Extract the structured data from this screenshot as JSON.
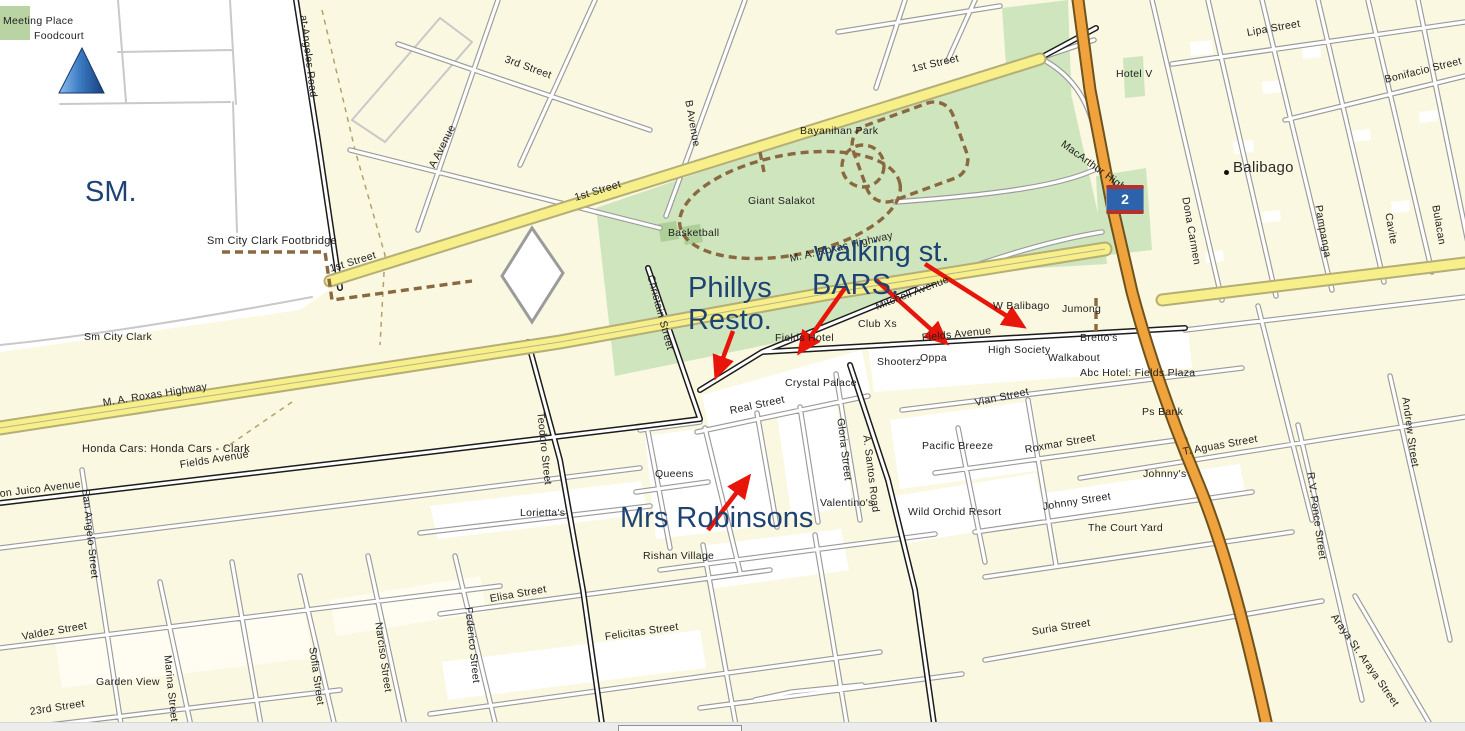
{
  "map": {
    "route_shield": {
      "number": "2"
    },
    "icons": [
      {
        "name": "blue-triangle-marker",
        "meaning": "map location cone marker"
      },
      {
        "name": "route-2-shield",
        "meaning": "highway route number 2"
      },
      {
        "name": "balibago-place-dot",
        "meaning": "place point marker"
      }
    ],
    "colors": {
      "annotation_blue": "#1e4373",
      "arrow_red": "#e8150a",
      "park_green": "#cfe5bd",
      "road_yellow": "#f7ef89",
      "highway_orange": "#f0a33c",
      "map_background": "#faf8e0"
    },
    "annotations": [
      {
        "text": "SM.",
        "x": 85,
        "y": 178,
        "rot": 0
      },
      {
        "text": "walking st.",
        "x": 814,
        "y": 238,
        "rot": 0
      },
      {
        "text": "BARS.",
        "x": 812,
        "y": 271,
        "rot": 0
      },
      {
        "text": "Phillys",
        "x": 688,
        "y": 274,
        "rot": 0
      },
      {
        "text": "Resto.",
        "x": 688,
        "y": 306,
        "rot": 0
      },
      {
        "text": "Mrs Robinsons",
        "x": 620,
        "y": 504,
        "rot": 0
      }
    ],
    "arrows": [
      {
        "x1": 845,
        "y1": 288,
        "x2": 801,
        "y2": 350
      },
      {
        "x1": 876,
        "y1": 280,
        "x2": 944,
        "y2": 341
      },
      {
        "x1": 925,
        "y1": 264,
        "x2": 1021,
        "y2": 325
      },
      {
        "x1": 733,
        "y1": 331,
        "x2": 717,
        "y2": 374
      },
      {
        "x1": 708,
        "y1": 530,
        "x2": 747,
        "y2": 479
      }
    ],
    "labels": [
      {
        "text": "Meeting Place",
        "x": 3,
        "y": 16,
        "rot": 0
      },
      {
        "text": "Foodcourt",
        "x": 34,
        "y": 31,
        "rot": 0
      },
      {
        "text": "Sm City Clark Footbridge",
        "x": 207,
        "y": 236,
        "rot": 0,
        "cls": "md"
      },
      {
        "text": "Sm City Clark",
        "x": 84,
        "y": 332,
        "rot": 0
      },
      {
        "text": "1st Street",
        "x": 330,
        "y": 264,
        "rot": -17
      },
      {
        "text": "at-Angeles Road",
        "x": 303,
        "y": 10,
        "rot": 83
      },
      {
        "text": "3rd Street",
        "x": 505,
        "y": 54,
        "rot": 20
      },
      {
        "text": "A Avenue",
        "x": 432,
        "y": 162,
        "rot": -63
      },
      {
        "text": "B Avenue",
        "x": 688,
        "y": 95,
        "rot": 80
      },
      {
        "text": "1st Street",
        "x": 575,
        "y": 193,
        "rot": -17
      },
      {
        "text": "1st Street",
        "x": 912,
        "y": 64,
        "rot": -13
      },
      {
        "text": "Bayanihan Park",
        "x": 800,
        "y": 126,
        "rot": 0
      },
      {
        "text": "Giant Salakot",
        "x": 748,
        "y": 196,
        "rot": 0
      },
      {
        "text": "Basketball",
        "x": 668,
        "y": 228,
        "rot": 0
      },
      {
        "text": "M. A. Roxas Highway",
        "x": 790,
        "y": 254,
        "rot": -13
      },
      {
        "text": "Hotel V",
        "x": 1116,
        "y": 69,
        "rot": 0
      },
      {
        "text": "Balibago",
        "x": 1233,
        "y": 160,
        "rot": 0,
        "cls": "lg"
      },
      {
        "text": "Lipa Street",
        "x": 1247,
        "y": 28,
        "rot": -10
      },
      {
        "text": "Bonifacio Street",
        "x": 1385,
        "y": 75,
        "rot": -14
      },
      {
        "text": "MacArthur Highway",
        "x": 1062,
        "y": 138,
        "rot": 36
      },
      {
        "text": "Dona Carmen",
        "x": 1185,
        "y": 192,
        "rot": 80
      },
      {
        "text": "Pampanga",
        "x": 1318,
        "y": 200,
        "rot": 80
      },
      {
        "text": "Cavite",
        "x": 1388,
        "y": 208,
        "rot": 80
      },
      {
        "text": "Bulacan",
        "x": 1435,
        "y": 200,
        "rot": 80
      },
      {
        "text": "Mitchell Avenue",
        "x": 876,
        "y": 302,
        "rot": -21
      },
      {
        "text": "Club Xs",
        "x": 858,
        "y": 319,
        "rot": 0
      },
      {
        "text": "Fields Hotel",
        "x": 775,
        "y": 333,
        "rot": 0
      },
      {
        "text": "Fields Avenue",
        "x": 922,
        "y": 333,
        "rot": -6
      },
      {
        "text": "W Balibago",
        "x": 993,
        "y": 301,
        "rot": 0
      },
      {
        "text": "Jumong",
        "x": 1062,
        "y": 304,
        "rot": 0
      },
      {
        "text": "Bretto's",
        "x": 1080,
        "y": 333,
        "rot": 0
      },
      {
        "text": "High Society",
        "x": 988,
        "y": 345,
        "rot": 0
      },
      {
        "text": "Walkabout",
        "x": 1048,
        "y": 353,
        "rot": 0
      },
      {
        "text": "Abc Hotel: Fields Plaza",
        "x": 1080,
        "y": 368,
        "rot": 0
      },
      {
        "text": "Shooterz",
        "x": 877,
        "y": 357,
        "rot": 0
      },
      {
        "text": "Oppa",
        "x": 920,
        "y": 353,
        "rot": 0
      },
      {
        "text": "Crystal Palace",
        "x": 785,
        "y": 378,
        "rot": 0
      },
      {
        "text": "Vian Street",
        "x": 975,
        "y": 398,
        "rot": -12
      },
      {
        "text": "Ps Bank",
        "x": 1142,
        "y": 407,
        "rot": 0
      },
      {
        "text": "Real Street",
        "x": 730,
        "y": 406,
        "rot": -12
      },
      {
        "text": "Gloria Street",
        "x": 840,
        "y": 413,
        "rot": 83
      },
      {
        "text": "A. Santos Road",
        "x": 866,
        "y": 430,
        "rot": 83
      },
      {
        "text": "Pacific Breeze",
        "x": 922,
        "y": 441,
        "rot": 0
      },
      {
        "text": "Queens",
        "x": 655,
        "y": 469,
        "rot": 0
      },
      {
        "text": "Valentino's",
        "x": 820,
        "y": 498,
        "rot": 0
      },
      {
        "text": "Wild Orchid Resort",
        "x": 908,
        "y": 507,
        "rot": 0
      },
      {
        "text": "Roxmar Street",
        "x": 1025,
        "y": 445,
        "rot": -10
      },
      {
        "text": "Johnny's",
        "x": 1143,
        "y": 469,
        "rot": 0
      },
      {
        "text": "T. Aguas Street",
        "x": 1183,
        "y": 447,
        "rot": -10
      },
      {
        "text": "Johnny Street",
        "x": 1043,
        "y": 502,
        "rot": -9
      },
      {
        "text": "The Court Yard",
        "x": 1088,
        "y": 523,
        "rot": 0
      },
      {
        "text": "Suria Street",
        "x": 1032,
        "y": 627,
        "rot": -9
      },
      {
        "text": "R.V. Ponce Street",
        "x": 1310,
        "y": 467,
        "rot": 82
      },
      {
        "text": "Andrew Street",
        "x": 1405,
        "y": 392,
        "rot": 82
      },
      {
        "text": "Araya St. Araya Street",
        "x": 1333,
        "y": 610,
        "rot": 55
      },
      {
        "text": "Honda Cars: Honda Cars - Clark",
        "x": 82,
        "y": 444,
        "rot": 0,
        "cls": "md"
      },
      {
        "text": "M. A. Roxas Highway",
        "x": 103,
        "y": 398,
        "rot": -9
      },
      {
        "text": "Fields Avenue",
        "x": 180,
        "y": 460,
        "rot": -9
      },
      {
        "text": "Don Juico Avenue",
        "x": -8,
        "y": 490,
        "rot": -7
      },
      {
        "text": "San Angelo Street",
        "x": 85,
        "y": 484,
        "rot": 84
      },
      {
        "text": "Valdez Street",
        "x": 22,
        "y": 632,
        "rot": -10
      },
      {
        "text": "Garden View",
        "x": 96,
        "y": 677,
        "rot": 0
      },
      {
        "text": "23rd Street",
        "x": 30,
        "y": 707,
        "rot": -9
      },
      {
        "text": "Marina Street",
        "x": 167,
        "y": 650,
        "rot": 84
      },
      {
        "text": "Sofia Street",
        "x": 312,
        "y": 642,
        "rot": 82
      },
      {
        "text": "Narciso Street",
        "x": 378,
        "y": 617,
        "rot": 82
      },
      {
        "text": "Federico Street",
        "x": 468,
        "y": 602,
        "rot": 84
      },
      {
        "text": "Elisa Street",
        "x": 490,
        "y": 594,
        "rot": -10
      },
      {
        "text": "Felicitas Street",
        "x": 605,
        "y": 632,
        "rot": -8
      },
      {
        "text": "Lorietta's",
        "x": 520,
        "y": 508,
        "rot": 0
      },
      {
        "text": "Rishan Village",
        "x": 643,
        "y": 551,
        "rot": 0
      },
      {
        "text": "Teodoro Street",
        "x": 540,
        "y": 407,
        "rot": 84
      },
      {
        "text": "Christain Street",
        "x": 650,
        "y": 270,
        "rot": 75
      }
    ]
  }
}
